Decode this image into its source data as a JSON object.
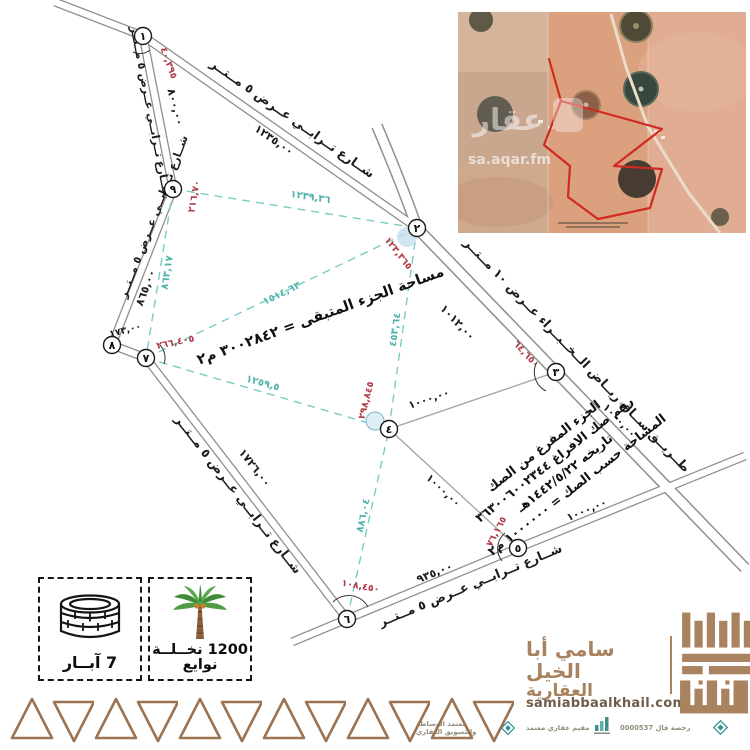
{
  "satellite": {
    "watermark_logo": "عقار",
    "watermark_domain": "sa.aqar.fm"
  },
  "diagram": {
    "vertices": {
      "v1": "١",
      "v2": "٢",
      "v3": "٣",
      "v4": "٤",
      "v5": "٥",
      "v6": "٦",
      "v7": "٧",
      "v8": "٨",
      "v9": "٩"
    },
    "roads": {
      "top_name": "شــارع تــرابــي عــرض ٥ مــتــر",
      "top_len": "١٢٣٥,٠٠",
      "upper_left_name": "شــارع تــرابــي عــرض ٥ مــتــر",
      "upper_left_len": "٨٠٠,٠٠",
      "left_name": "شــارع تــرابــي عــرض ٥ مــتــر",
      "left_len": "٨٦٥,٠٠",
      "lower_left_name": "شــارع تــرابــي عــرض ٥ مــتــر",
      "lower_left_len": "١٧٢٦,٠٠",
      "bottom_name": "شــارع تــرابــي عــرض ٥ مــتــر",
      "bottom_len": "٩٣٥,٠٠",
      "main_name": "طــريــق ســاق ريــاض الــخــبــراء عــرض ١٠ مــتــر",
      "main_len": "١٠١٢,٠٠"
    },
    "diagonals": {
      "v9_v2": "١٢٣٩,٣٦",
      "v7_v2": "١٥١٤,٦٣",
      "v2_v4": "٤٥٣,٦٤",
      "v7_v4": "١٢٥٩,٥",
      "v9_v7": "٨٦٣,١٧",
      "v6_v4": "٨٨٦,٠٤"
    },
    "square_side": "١٠٠٠,٠٠",
    "angles": {
      "v1": "٤٠,٣٩٥",
      "v2": "١٢٣,٣٦٥",
      "v3": "٦٤,٦٥٠",
      "v4": "٢٩٨,٨٤٥",
      "v5": "٧٦,١٦٥",
      "v6": "١٠٨,٤٥٠",
      "v7": "٢٦٦,٤٠٥",
      "v9": "٢١٦,٧٠",
      "seg_8_7": "١٧٣,٠٠"
    },
    "notes": {
      "remaining_area": "مساحة الجزء المتبقى = ٣٠٠٢٨٤٢ م٢",
      "deed_line1": "الجزء المفرغ من الصك",
      "deed_line2": "رقم صك الافراغ ٣٦٣٠٠٦٠٠٢٣٤٤",
      "deed_line3": "تاريخه ١٤٤٢/٥/٢٢هـ",
      "deed_line4": "المساحة حسب الصك = ١٠٠٠٠٠٠ م٢"
    }
  },
  "legend": {
    "wells_label": "7 آبــار",
    "palms_label_line1": "1200 نخــلــة",
    "palms_label_line2": "نوايع"
  },
  "branding": {
    "company_line1": "سامي أبا الخيل",
    "company_line2": "العقارية",
    "website": "samiabbaalkhail.com",
    "cert_brokerage_line1": "معتمد الوساطة",
    "cert_brokerage_line2": "والتسويق العقاري",
    "cert_appraiser": "مقيم عقاري معتمد",
    "cert_license": "رخصة فال 0000537"
  },
  "colors": {
    "accent": "#a9825f",
    "teal": "#4fb3ac",
    "red": "#b23a44"
  }
}
